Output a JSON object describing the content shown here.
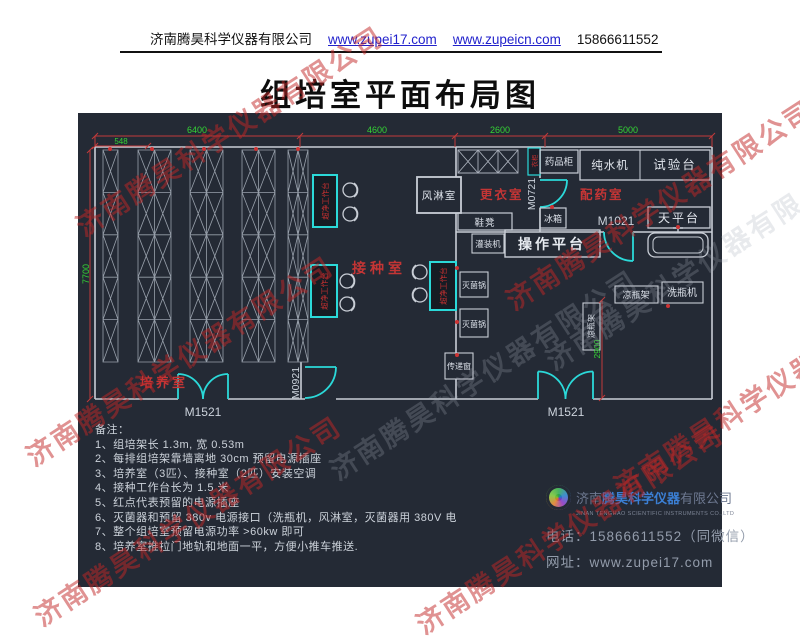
{
  "header": {
    "company": "济南腾昊科学仪器有限公司",
    "url1": "www.zupei17.com",
    "url2": "www.zupeicn.com",
    "phone": "15866611552"
  },
  "title": "组培室平面布局图",
  "watermark": {
    "text": "济南腾昊科学仪器有限公司"
  },
  "plan": {
    "dims": {
      "culture_w": "6400",
      "inoculation_w": "4600",
      "changing_w": "2600",
      "dispensing_w": "5000",
      "sub": "548",
      "left_h": "7700",
      "right_h": "2900"
    },
    "rooms": {
      "culture": "培养室",
      "inoculation": "接种室",
      "changing": "更衣室",
      "dispensing": "配药室"
    },
    "doors": {
      "double": "M1521",
      "m0921": "M0921",
      "m0721": "M0721",
      "m1021": "M1021"
    },
    "equipment": {
      "clean_bench": "超净工作台",
      "air_shower": "风淋室",
      "medicine_cabinet": "药品柜",
      "wardrobe": "衣柜",
      "pure_water": "纯水机",
      "test_bench": "试验台",
      "fridge": "冰箱",
      "shoe_bench": "鞋凳",
      "filling_machine": "灌装机",
      "operation_platform": "操作平台",
      "balance_table": "天平台",
      "sterilizer": "灭菌锅",
      "transfer_window": "传递窗",
      "bottle_rack": "凉瓶架",
      "bottle_washer": "洗瓶机"
    }
  },
  "notes": {
    "title": "备注：",
    "items": [
      "1、组培架长 1.3m, 宽 0.53m",
      "2、每排组培架靠墙离地 30cm 预留电源插座",
      "3、培养室（3匹）、接种室（2匹）安装空调",
      "4、接种工作台长为 1.5 米",
      "5、红点代表预留的电源插座",
      "6、灭菌器和预留 380v 电源接口（洗瓶机，风淋室，灭菌器用 380V 电",
      "7、整个组培室预留电源功率 >60kw 即可",
      "8、培养室推拉门地轨和地面一平，方便小推车推送."
    ]
  },
  "footer": {
    "company_prefix": "济南",
    "company_brand": "腾昊科学仪器",
    "company_suffix": "有限公司",
    "company_en": "JINAN TENGHAO SCIENTIFIC INSTRUMENTS CO.,LTD",
    "phone_label": "电话：",
    "phone": "15866611552（同微信）",
    "web_label": "网址：",
    "website": "www.zupei17.com"
  }
}
